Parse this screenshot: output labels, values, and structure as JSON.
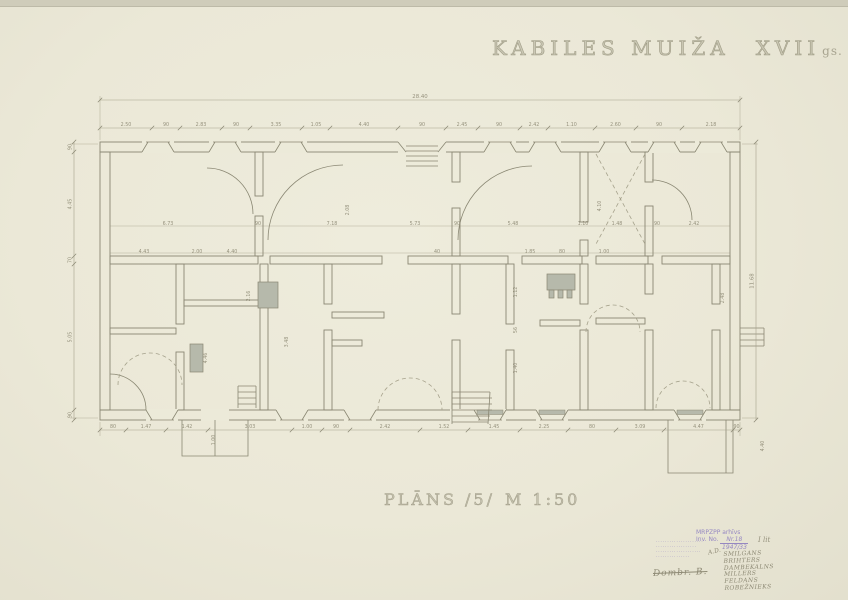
{
  "sheet": {
    "title_main": "KABILES MUIŽA",
    "title_century": "XVII",
    "title_suffix": "gs.",
    "plan_label": "PLĀNS /5/",
    "scale_label": "M 1:50"
  },
  "stamps": {
    "archive": {
      "line1": "MRPZPP arhīvs",
      "inv_label": "Inv. No.",
      "inv_number": "Nr.18",
      "inv_fraction": "1947/33",
      "inv_note": "I lit",
      "pencil_prefix": "A.D.",
      "names": [
        "Smilgans",
        "Brihters",
        "Dambekalns",
        "Millers",
        "Feldans",
        "Robežnieks"
      ]
    },
    "small_stamp_lines": [
      "·····················",
      "··················",
      "····················",
      "···············"
    ],
    "signature": "Dombr. B."
  },
  "colors": {
    "paper": "#ecead9",
    "pencil": "#8a8773",
    "light": "#a6a28c",
    "shade": "#b6b9ab",
    "stamp_purple": "#8d7ec0",
    "pencil_text": "#8e8a75"
  },
  "plan": {
    "walls": [
      [
        100,
        142,
        640,
        10
      ],
      [
        100,
        410,
        640,
        10
      ],
      [
        100,
        152,
        10,
        258
      ],
      [
        730,
        152,
        10,
        258
      ],
      [
        110,
        256,
        148,
        8
      ],
      [
        270,
        256,
        112,
        8
      ],
      [
        408,
        256,
        100,
        8
      ],
      [
        522,
        256,
        60,
        8
      ],
      [
        596,
        256,
        52,
        8
      ],
      [
        662,
        256,
        68,
        8
      ],
      [
        255,
        152,
        8,
        44
      ],
      [
        255,
        216,
        8,
        40
      ],
      [
        452,
        152,
        8,
        30
      ],
      [
        452,
        208,
        8,
        48
      ],
      [
        580,
        152,
        8,
        70
      ],
      [
        580,
        240,
        8,
        16
      ],
      [
        645,
        152,
        8,
        30
      ],
      [
        645,
        206,
        8,
        50
      ],
      [
        176,
        264,
        8,
        60
      ],
      [
        176,
        352,
        8,
        58
      ],
      [
        260,
        264,
        8,
        146
      ],
      [
        324,
        264,
        8,
        40
      ],
      [
        324,
        330,
        8,
        80
      ],
      [
        452,
        264,
        8,
        50
      ],
      [
        452,
        340,
        8,
        70
      ],
      [
        506,
        264,
        8,
        60
      ],
      [
        506,
        350,
        8,
        60
      ],
      [
        580,
        264,
        8,
        40
      ],
      [
        580,
        330,
        8,
        80
      ],
      [
        645,
        264,
        8,
        30
      ],
      [
        645,
        330,
        8,
        80
      ],
      [
        712,
        264,
        8,
        40
      ],
      [
        712,
        330,
        8,
        80
      ],
      [
        110,
        328,
        66,
        6
      ],
      [
        184,
        300,
        76,
        6
      ],
      [
        332,
        312,
        52,
        6
      ],
      [
        332,
        340,
        30,
        6
      ],
      [
        540,
        320,
        40,
        6
      ],
      [
        596,
        318,
        49,
        6
      ]
    ],
    "stoves": [
      [
        258,
        282,
        20,
        26
      ],
      [
        190,
        344,
        13,
        28
      ],
      [
        547,
        274,
        28,
        16
      ],
      [
        549,
        290,
        5,
        8
      ],
      [
        558,
        290,
        5,
        8
      ],
      [
        567,
        290,
        5,
        8
      ]
    ],
    "clears": [
      [
        398,
        141,
        48,
        12
      ],
      [
        201,
        409,
        28,
        12
      ],
      [
        450,
        409,
        40,
        13
      ]
    ],
    "windows_top": {
      "outer": 142,
      "inner": 152,
      "cx": [
        158,
        225,
        291,
        500,
        545,
        615,
        664,
        711
      ],
      "gray": []
    },
    "windows_bottom": {
      "outer": 420,
      "inner": 410,
      "cx": [
        162,
        292,
        360,
        490,
        552,
        690
      ],
      "gray": [
        490,
        552,
        690
      ]
    },
    "chains": [
      {
        "dir": "h",
        "pos": 100,
        "ticks": [
          100,
          740
        ],
        "values": [
          "28.40"
        ]
      },
      {
        "dir": "h",
        "pos": 128,
        "ticks": [
          100,
          152,
          180,
          222,
          250,
          302,
          330,
          398,
          446,
          478,
          520,
          548,
          595,
          636,
          682,
          740
        ],
        "values": [
          "2.50",
          "90",
          "2.83",
          "90",
          "3.35",
          "1.05",
          "4.40",
          "90",
          "2.45",
          "90",
          "2.42",
          "1.10",
          "2.60",
          "90",
          "2.18"
        ]
      },
      {
        "dir": "h",
        "pos": 430,
        "ticks": [
          100,
          126,
          166,
          208,
          292,
          322,
          350,
          420,
          468,
          520,
          568,
          616,
          664,
          733,
          740
        ],
        "values": [
          "80",
          "1.47",
          "1.42",
          "3.03",
          "1.00",
          "90",
          "2.42",
          "1.52",
          "1.45",
          "2.25",
          "80",
          "3.09",
          "4.47",
          "90"
        ]
      },
      {
        "dir": "v",
        "pos": 74,
        "ticks": [
          142,
          152,
          256,
          264,
          410,
          420
        ],
        "values": [
          "90",
          "4.45",
          "70",
          "5.05",
          "90"
        ]
      },
      {
        "dir": "v",
        "pos": 756,
        "ticks": [
          142,
          420
        ],
        "values": [
          "11.68"
        ]
      }
    ],
    "labels": [
      [
        168,
        225,
        "6.73",
        0
      ],
      [
        258,
        225,
        "90",
        0
      ],
      [
        332,
        225,
        "7.18",
        0
      ],
      [
        415,
        225,
        "5.73",
        0
      ],
      [
        457,
        225,
        "90",
        0
      ],
      [
        513,
        225,
        "5.48",
        0
      ],
      [
        583,
        225,
        "1.10",
        0
      ],
      [
        617,
        225,
        "1.48",
        0
      ],
      [
        657,
        225,
        "90",
        0
      ],
      [
        694,
        225,
        "2.42",
        0
      ],
      [
        144,
        253,
        "4.43",
        0
      ],
      [
        197,
        253,
        "2.00",
        0
      ],
      [
        232,
        253,
        "4.40",
        0
      ],
      [
        437,
        253,
        "40",
        0
      ],
      [
        530,
        253,
        "1.85",
        0
      ],
      [
        562,
        253,
        "80",
        0
      ],
      [
        604,
        253,
        "1.00",
        0
      ],
      [
        349,
        210,
        "2.08",
        1
      ],
      [
        601,
        206,
        "4.10",
        1
      ],
      [
        517,
        292,
        "1.12",
        1
      ],
      [
        517,
        330,
        "56",
        1
      ],
      [
        517,
        368,
        "1.40",
        1
      ],
      [
        724,
        298,
        "2.48",
        1
      ],
      [
        207,
        358,
        "4.46",
        1
      ],
      [
        250,
        296,
        "2.16",
        1
      ],
      [
        288,
        342,
        "3.48",
        1
      ],
      [
        764,
        446,
        "4.40",
        1
      ],
      [
        215,
        440,
        "1.00",
        1
      ]
    ],
    "paths_pencil": [
      "M406,146H438M406,151H438M406,156H438M406,161H438M406,166H438M398,142L406,152M446,142L438,152",
      "M452,392H490M452,398H492M452,404H492M452,410H492M452,416H490M452,422H488M452,392V424M490,392L488,424",
      "M238,386H256M238,392H256M238,398H256M238,404H256M238,386V408M256,386V408",
      "M740,328H764M740,334H764M740,340H764M740,346H764M764,328V346",
      "M182,420V456H248V420M215,420V456",
      "M668,420V473H733V420M726,420V473",
      "M253,214A46,46 0 0 0 207,168",
      "M268,240A75,75 0 0 1 343,165",
      "M458,240A74,74 0 0 1 532,166",
      "M652,180A40,40 0 0 1 692,220",
      "M110,374A36,36 0 0 1 146,410"
    ],
    "paths_light": [
      "M100,96V140",
      "M740,96V140",
      "M70,144H98",
      "M70,418H98",
      "M742,144H758",
      "M742,418H758",
      "M100,422V436",
      "M740,422V436",
      "M110,226H730",
      "M110,253H730"
    ],
    "paths_dashed": [
      "M596,154L645,244",
      "M645,154L596,244",
      "M118,385A32,32 0 0 1 182,385",
      "M378,410A32,32 0 0 1 442,410",
      "M656,408A27,27 0 0 1 710,408",
      "M586,332A27,27 0 0 1 640,332"
    ]
  }
}
